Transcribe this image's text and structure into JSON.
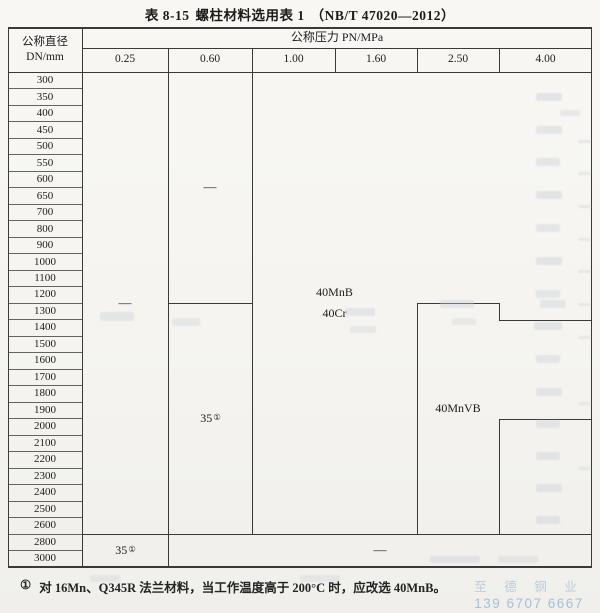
{
  "page": {
    "title_prefix": "表 8-15",
    "title_main": "螺柱材料选用表 1",
    "title_standard": "（NB/T 47020—2012）"
  },
  "table": {
    "row_header_line1": "公称直径",
    "row_header_line2": "DN/mm",
    "pressure_header": "公称压力 PN/MPa",
    "pressure_columns": [
      "0.25",
      "0.60",
      "1.00",
      "1.60",
      "2.50",
      "4.00"
    ],
    "diameters": [
      "300",
      "350",
      "400",
      "450",
      "500",
      "550",
      "600",
      "650",
      "700",
      "800",
      "900",
      "1000",
      "1100",
      "1200",
      "1300",
      "1400",
      "1500",
      "1600",
      "1700",
      "1800",
      "1900",
      "2000",
      "2100",
      "2200",
      "2300",
      "2400",
      "2500",
      "2600",
      "2800",
      "3000"
    ],
    "cells": {
      "col025_main": "—",
      "col060_upper": "—",
      "col060_lower_base": "35",
      "col060_lower_sup": "①",
      "merged_high_line1": "40MnB",
      "merged_high_line2": "40Cr",
      "col250_material": "40MnVB",
      "bottom_left_base": "35",
      "bottom_left_sup": "①",
      "bottom_merged": "—"
    }
  },
  "footnote": {
    "marker": "①",
    "text": "对 16Mn、Q345R 法兰材料，当工作温度高于 200°C 时，应改选 40MnB。"
  },
  "watermark": {
    "company": "至 德 钢 业",
    "phone": "139 6707 6667"
  },
  "colors": {
    "paper": "#f6f5f1",
    "line": "#3a3a3a",
    "ink": "#1b1b1b",
    "watermark_blue": "#a8c2dc"
  }
}
